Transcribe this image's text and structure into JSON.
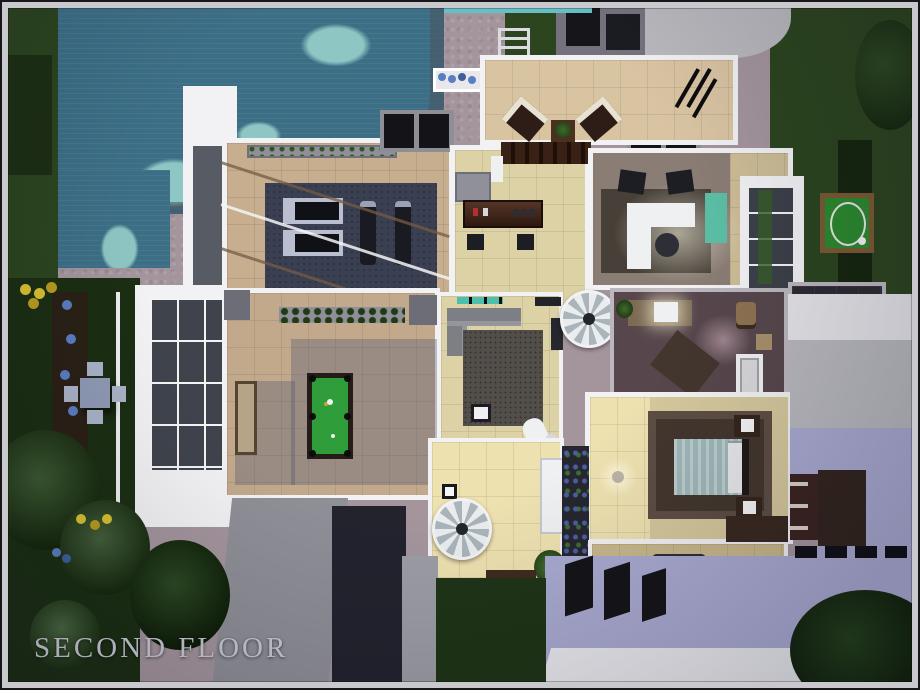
{
  "caption": {
    "text": "SECOND FLOOR"
  },
  "palette": {
    "frame": "#c9c9cd",
    "frame_edge": "#17171a",
    "stone": "#a4959d",
    "water": "#3c6f86",
    "water_light": "#8ec6c3",
    "grass": "#2c451f",
    "grass_dark": "#1b2e12",
    "grass_light": "#3d5a2c",
    "hedge": "#16260e",
    "wall_white": "#f2f2f4",
    "wall_gray": "#bcb7be",
    "roof_gray": "#75727d",
    "concrete": "#b8b8bd",
    "concrete_dark": "#8f8f97",
    "roof_lavender": "#a9aad0",
    "roof_navy": "#23232e",
    "floor_tan": "#c6ae8e",
    "floor_beige": "#ddd2a6",
    "floor_beige_lit": "#eee1b0",
    "floor_terracotta": "#c2a98c",
    "floor_office": "#8a7d74",
    "floor_bath": "#57474c",
    "floor_dark_tile": "#2e2b33",
    "rug_navy": "#3a3f52",
    "rug_gray": "#524f4b",
    "rug_brown": "#43362e",
    "wood_dark": "#44291e",
    "pool_felt": "#2f9e3a",
    "teal_accent": "#4cbfae",
    "teal_cabinet": "#5bbfa4",
    "white_furniture": "#eef0f2",
    "black_object": "#141418",
    "caption_color": "#c9cad3",
    "flower_yellow": "#d8c22f",
    "flower_blue": "#5a7ec2"
  },
  "objects": {
    "pool": "swimming pool",
    "gym": "gym (treadmills, exercise bikes)",
    "bar": "bar counter with stools",
    "balcony": "balcony with lounge chairs and telescope",
    "office": "home office desk",
    "billiards": "billiards table terrace",
    "stairs": "two spiral staircases",
    "bathroom": "bathroom with tub, toilet, vanity",
    "bedroom": "bedroom with double bed",
    "putting_green": "putting green",
    "bbq": "BBQ grill terrace",
    "garden": "garden with dining set and flower beds"
  }
}
